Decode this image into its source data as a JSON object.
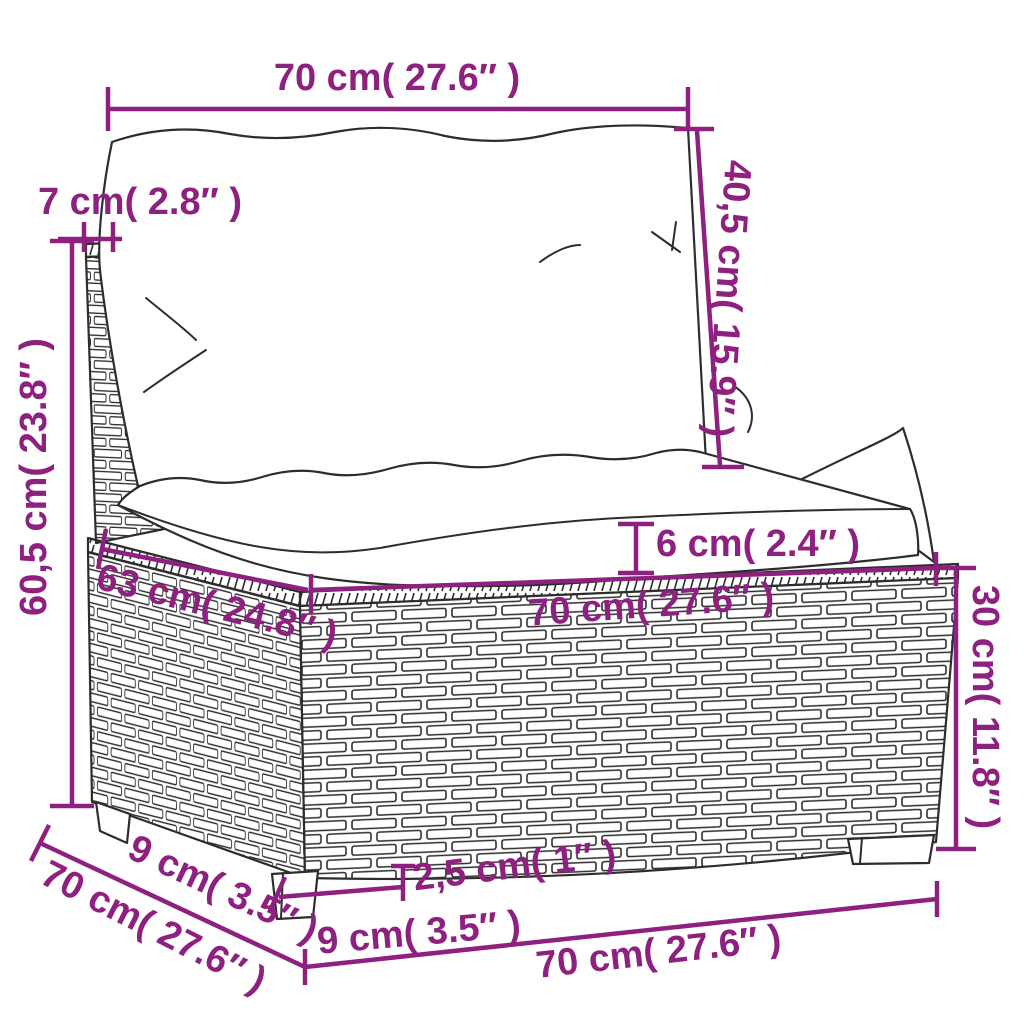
{
  "diagram": {
    "type": "furniture-dimension-diagram",
    "subject": "rattan garden sofa middle section with cushions",
    "colors": {
      "dimension": "#8e2080",
      "outline": "#2d2d2d",
      "background": "#ffffff"
    },
    "labels": {
      "back_cushion_width": "70 cm( 27.6″ )",
      "back_panel_depth": "7 cm( 2.8″ )",
      "back_cushion_height": "40,5 cm( 15.9″ )",
      "overall_height": "60,5 cm( 23.8″ )",
      "seat_cushion_thickness": "6 cm( 2.4″ )",
      "seat_depth": "63 cm( 24.8″ )",
      "seat_width": "70 cm( 27.6″ )",
      "base_height": "30 cm( 11.8″ )",
      "side_leg_inset": "9 cm( 3.5″ )",
      "bottom_depth": "70 cm( 27.6″ )",
      "leg_height": "2,5 cm( 1″ )",
      "front_leg_inset": "9 cm( 3.5″ )",
      "bottom_width": "70 cm( 27.6″ )"
    }
  }
}
